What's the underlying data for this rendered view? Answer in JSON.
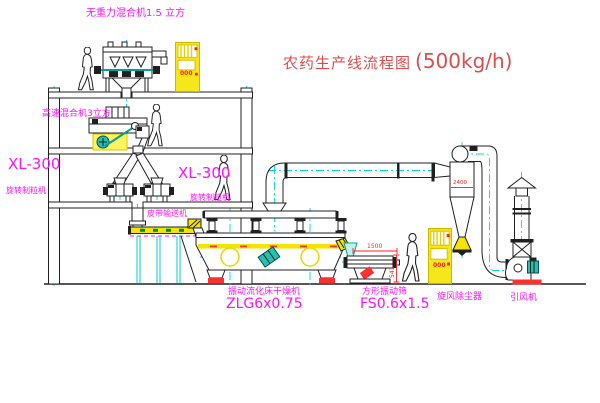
{
  "diagram": {
    "title": "农药生产线流程图",
    "capacity": "(500kg/h)"
  },
  "equipment_labels": {
    "gravity_mixer": "无重力混合机1.5 立方",
    "high_speed_mixer": "高速混合机3立方",
    "granulator_left_model": "XL-300",
    "granulator_left_name": "旋转制粒机",
    "granulator_right_model": "XL-300",
    "granulator_right_name": "旋转制粒机",
    "belt_conveyor": "皮带输送机",
    "dryer_name": "振动流化床干燥机",
    "dryer_model": "ZLG6x0.75",
    "sieve_name": "方形振动筛",
    "sieve_model": "FS0.6x1.5",
    "cyclone": "旋风除尘器",
    "induced_draft_fan": "引风机"
  },
  "dimensions": {
    "sieve_length": "1500",
    "sieve_height": "541",
    "cyclone_dim": "2400"
  },
  "cabinet_indicators": {
    "cabinet1": "000",
    "cabinet2": "000"
  },
  "colors": {
    "line": "#202020",
    "centerline": "#00d8d8",
    "highlight_yellow": "#f5e400",
    "label_magenta": "#ff10ff",
    "title_red": "#d94f4f",
    "dimension_red": "#ff2020",
    "motor_teal": "#25c0b2"
  }
}
